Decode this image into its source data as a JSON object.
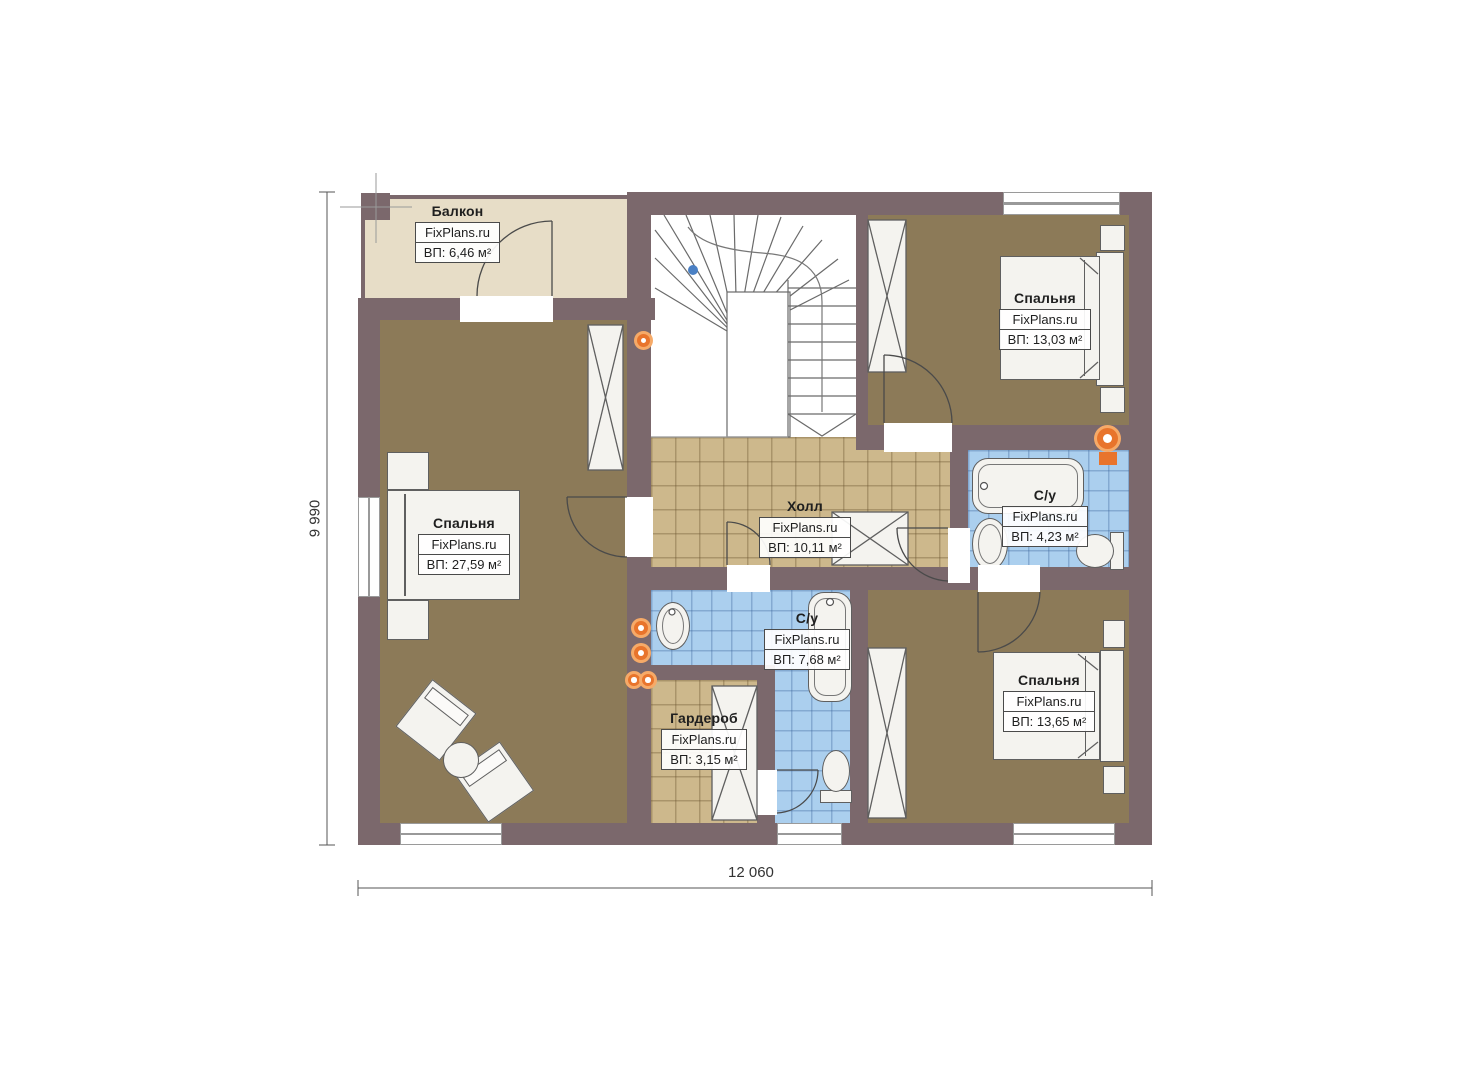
{
  "plan": {
    "brand": "FixPlans.ru",
    "rooms": [
      {
        "id": "balcony",
        "name": "Балкон",
        "area": "ВП: 6,46 м²"
      },
      {
        "id": "bedroom-left",
        "name": "Спальня",
        "area": "ВП: 27,59 м²"
      },
      {
        "id": "bedroom-top-right",
        "name": "Спальня",
        "area": "ВП: 13,03 м²"
      },
      {
        "id": "hall",
        "name": "Холл",
        "area": "ВП: 10,11 м²"
      },
      {
        "id": "bathroom-right",
        "name": "С/у",
        "area": "ВП: 4,23 м²"
      },
      {
        "id": "bathroom-center",
        "name": "С/у",
        "area": "ВП: 7,68 м²"
      },
      {
        "id": "wardrobe",
        "name": "Гардероб",
        "area": "ВП: 3,15 м²"
      },
      {
        "id": "bedroom-bottom-right",
        "name": "Спальня",
        "area": "ВП: 13,65 м²"
      }
    ],
    "dimensions": {
      "bottom": "12 060",
      "left": "9 990"
    },
    "colors": {
      "wall": "#7b686c",
      "bedroom_floor": "#8c7a58",
      "hall_tile": "#cdb88c",
      "bath_tile": "#abcfee",
      "balcony": "#e7ddc7",
      "fixture_orange": "#e8742c",
      "marker_blue": "#4a80c4"
    }
  }
}
